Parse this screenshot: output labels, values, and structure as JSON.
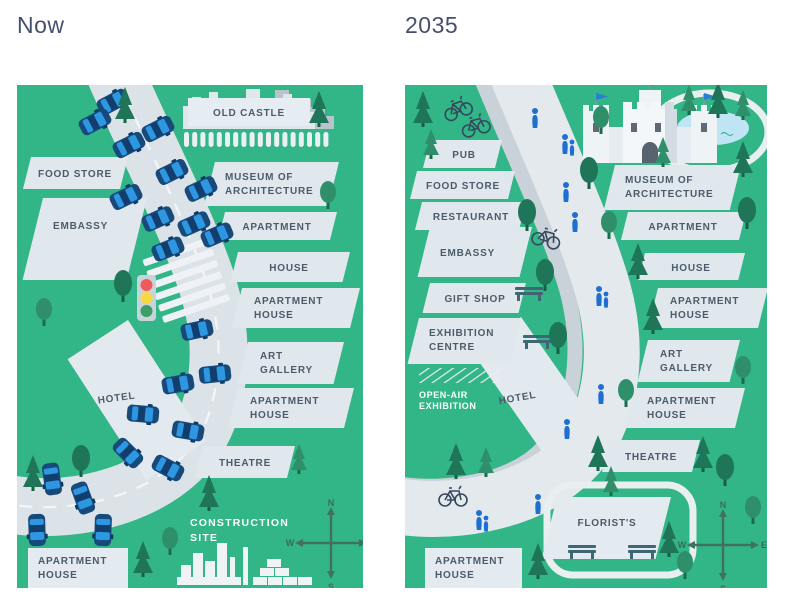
{
  "page": {
    "title_now": "Now",
    "title_future": "2035"
  },
  "compass": {
    "n": "N",
    "e": "E",
    "s": "S",
    "w": "W"
  },
  "colors": {
    "map_green": "#32b587",
    "road": "#dce3e8",
    "walkway": "#e4e9ed",
    "bike_lane": "#c9d2d9",
    "label_bg": "#e0e8ee",
    "label_text": "#4c5b6a",
    "tree_dark": "#1f7557",
    "tree_mid": "#2e8f6a",
    "car_body_blue": "#17497b",
    "car_window_blue": "#2e97e2",
    "person_blue": "#1e6fd0",
    "pond_blue": "#bfe4f4",
    "traffic_red": "#ef5b5b",
    "traffic_yellow": "#f7d843",
    "traffic_green": "#3e9e66",
    "flag_blue": "#2a7fd4"
  },
  "now": {
    "old_castle": "OLD CASTLE",
    "food_store": "FOOD STORE",
    "embassy": "EMBASSY",
    "museum_line1": "MUSEUM OF",
    "museum_line2": "ARCHITECTURE",
    "apartment": "APARTMENT",
    "house": "HOUSE",
    "apartment_house1_line1": "APARTMENT",
    "apartment_house1_line2": "HOUSE",
    "art_gallery_line1": "ART",
    "art_gallery_line2": "GALLERY",
    "apartment_house2_line1": "APARTMENT",
    "apartment_house2_line2": "HOUSE",
    "hotel": "HOTEL",
    "theatre": "THEATRE",
    "construction_line1": "CONSTRUCTION",
    "construction_line2": "SITE",
    "apartment_house3_line1": "APARTMENT",
    "apartment_house3_line2": "HOUSE"
  },
  "future": {
    "pub": "PUB",
    "food_store": "FOOD STORE",
    "restaurant": "RESTAURANT",
    "embassy": "EMBASSY",
    "gift_shop": "GIFT SHOP",
    "exhibition_line1": "EXHIBITION",
    "exhibition_line2": "CENTRE",
    "open_air_line1": "OPEN-AIR",
    "open_air_line2": "EXHIBITION",
    "hotel": "HOTEL",
    "museum_line1": "MUSEUM OF",
    "museum_line2": "ARCHITECTURE",
    "apartment": "APARTMENT",
    "house": "HOUSE",
    "apartment_house1_line1": "APARTMENT",
    "apartment_house1_line2": "HOUSE",
    "art_gallery_line1": "ART",
    "art_gallery_line2": "GALLERY",
    "apartment_house2_line1": "APARTMENT",
    "apartment_house2_line2": "HOUSE",
    "theatre": "THEATRE",
    "florists": "FLORIST'S",
    "apartment_house3_line1": "APARTMENT",
    "apartment_house3_line2": "HOUSE"
  }
}
